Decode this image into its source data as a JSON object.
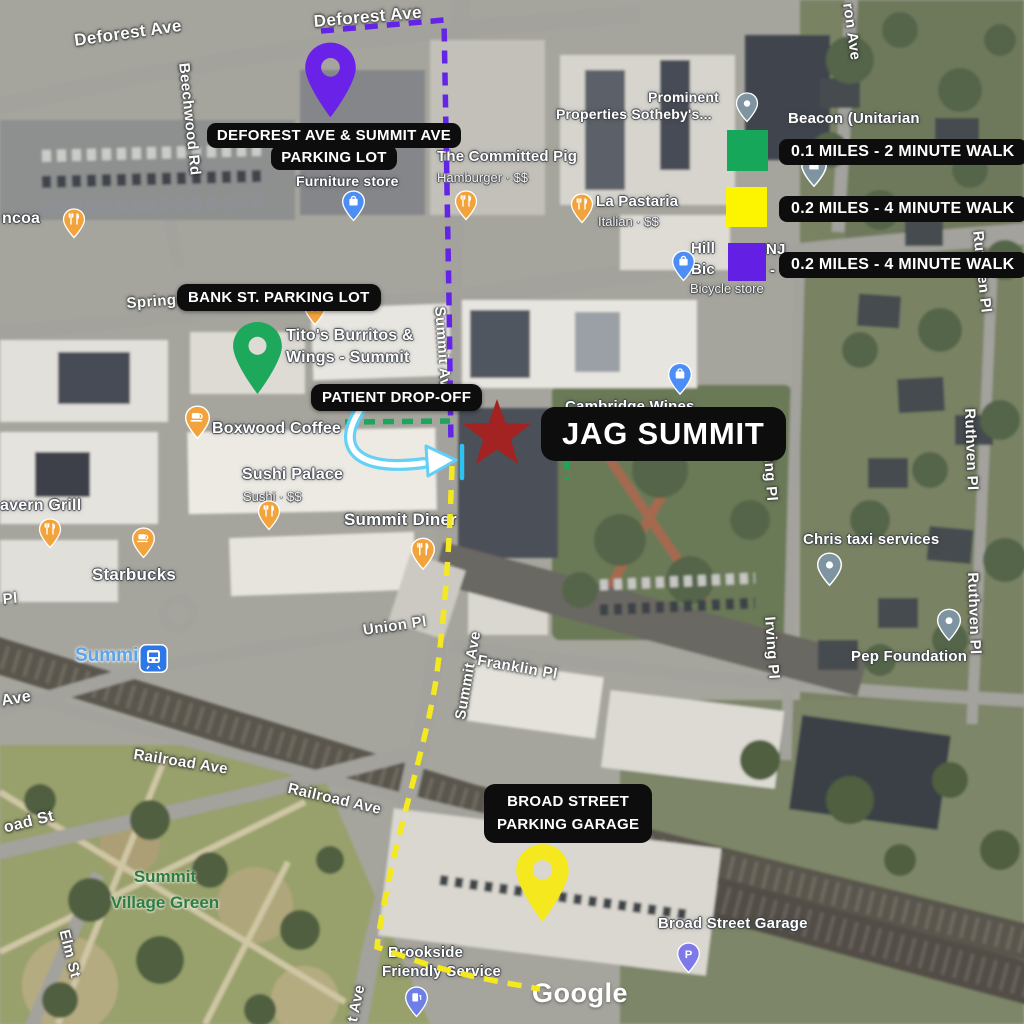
{
  "colors": {
    "route_purple": "#6424e6",
    "route_green": "#1ca55b",
    "route_yellow": "#f4e821",
    "drop_off_cyan": "#2bc3f2",
    "arrow_blue": "#5fd0f7",
    "star_red": "#a32322",
    "pill_bg": "#0d0d0d",
    "pin_purple": "#6a22e8",
    "pin_green": "#1ea85c",
    "pin_yellow": "#f6e81e"
  },
  "legend": {
    "items": [
      {
        "id": "green",
        "color": "#17a75b",
        "label": "0.1 MILES - 2 MINUTE WALK"
      },
      {
        "id": "yellow",
        "color": "#fdf400",
        "label": "0.2 MILES - 4 MINUTE WALK"
      },
      {
        "id": "purple",
        "color": "#6320e4",
        "label": "0.2 MILES - 4 MINUTE WALK"
      }
    ]
  },
  "annotations": {
    "deforest_lot": {
      "line1": "DEFOREST AVE & SUMMIT AVE",
      "line2": "PARKING LOT"
    },
    "bank_lot": {
      "label": "BANK ST. PARKING LOT"
    },
    "dropoff": {
      "label": "PATIENT DROP-OFF"
    },
    "jag": {
      "label": "JAG SUMMIT"
    },
    "broad_garage": {
      "line1": "BROAD STREET",
      "line2": "PARKING GARAGE"
    }
  },
  "markers": {
    "deforest_pin": "purple-map-pin",
    "bank_pin": "green-map-pin",
    "broad_pin": "yellow-map-pin",
    "jag_star": "red-star"
  },
  "streets": {
    "deforest_left": "Deforest Ave",
    "deforest_right": "Deforest Ave",
    "beechwood": "Beechwood Rd",
    "spring": "Spring",
    "summit_upper": "Summit Ave",
    "summit_lower": "Summit Ave",
    "union_pl": "Union Pl",
    "franklin": "Franklin Pl",
    "railroad_1": "Railroad Ave",
    "railroad_2": "Railroad Ave",
    "irving_upper": "Irving Pl",
    "irving_lower": "Irving Pl",
    "ruthven_top": "Ruthven Pl",
    "ruthven_mid": "Ruthven Pl",
    "ruthven_low": "Ruthven Pl",
    "ron_ave": "ron Ave",
    "broad_st": "oad St",
    "elm": "Elm St",
    "pl_frag": "Pl",
    "ave_frag": "Ave",
    "t_ave_frag": "t Ave"
  },
  "pois": {
    "ncoa": {
      "name": "ncoa",
      "icon": "restaurant-pin"
    },
    "tavern": {
      "name": "avern Grill",
      "icon": "restaurant-pin"
    },
    "starbucks": {
      "name": "Starbucks",
      "icon": "coffee-pin"
    },
    "boxwood": {
      "name": "Boxwood Coffee",
      "icon": "coffee-pin"
    },
    "sushi": {
      "name": "Sushi Palace",
      "sub": "Sushi · $$",
      "icon": "restaurant-pin"
    },
    "diner": {
      "name": "Summit Diner",
      "icon": "restaurant-pin"
    },
    "titos": {
      "line1": "Tito's Burritos &",
      "line2": "Wings - Summit",
      "icon": "restaurant-pin"
    },
    "pig": {
      "name": "The Committed Pig",
      "sub": "Hamburger · $$",
      "icon": "restaurant-pin"
    },
    "pastaria": {
      "name": "La Pastaria",
      "sub": "Italian · $$",
      "icon": "restaurant-pin"
    },
    "furniture": {
      "name": "Furniture store",
      "icon": "shopping-bag-pin"
    },
    "prominent": {
      "line1": "Prominent",
      "line2": "Properties Sotheby's...",
      "icon": "place-pin"
    },
    "beacon": {
      "name": "Beacon (Unitarian",
      "icon": "church-pin"
    },
    "hill": {
      "frag1": "Hill",
      "frag2": "NJ",
      "frag3": "Bic",
      "frag4": "-",
      "sub": "Bicycle store",
      "icon": "shopping-bag-pin"
    },
    "cambridge": {
      "name": "Cambridge Wines",
      "icon": "shopping-bag-pin"
    },
    "chris": {
      "name": "Chris taxi services",
      "icon": "place-pin"
    },
    "pep": {
      "name": "Pep Foundation",
      "icon": "place-pin"
    },
    "garage": {
      "name": "Broad Street Garage",
      "icon": "parking-pin"
    },
    "brookside": {
      "line1": "Brookside",
      "line2": "Friendly Service",
      "icon": "gas-station-pin"
    },
    "station": {
      "name": "Summit",
      "icon": "train-station-badge"
    },
    "village_green": {
      "line1": "Summit",
      "line2": "Village Green"
    }
  },
  "attribution": {
    "google": "Google"
  }
}
